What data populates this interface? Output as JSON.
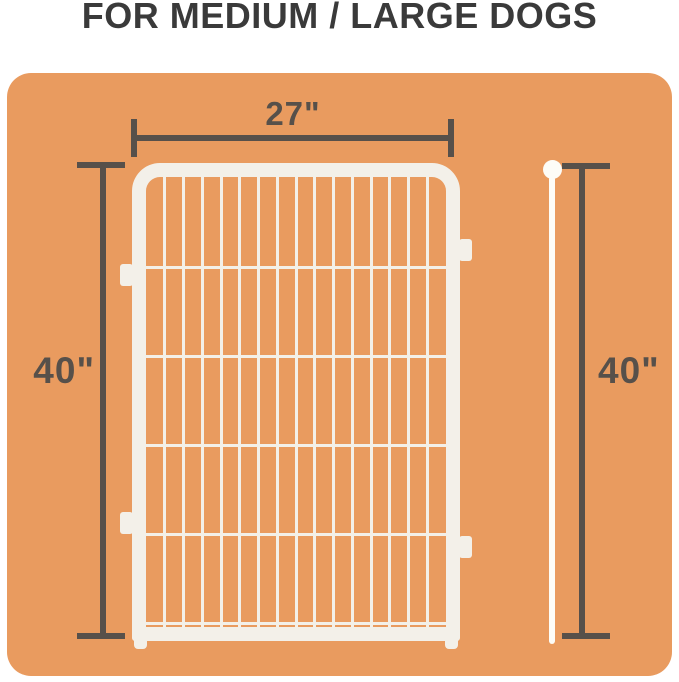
{
  "title": "FOR MEDIUM / LARGE DOGS",
  "dimensions": {
    "panel_width": "27\"",
    "panel_height": "40\"",
    "pole_height": "40\""
  },
  "fence": {
    "vertical_bars": 15,
    "horizontal_bars": 5
  },
  "colors": {
    "canvas_background": "#e99b5f",
    "dimension_marks": "#57504a",
    "title_text": "#3a3a3a",
    "fence_panel": "#f3f0e9",
    "pole": "#fdfcf7",
    "page_background": "#ffffff"
  }
}
